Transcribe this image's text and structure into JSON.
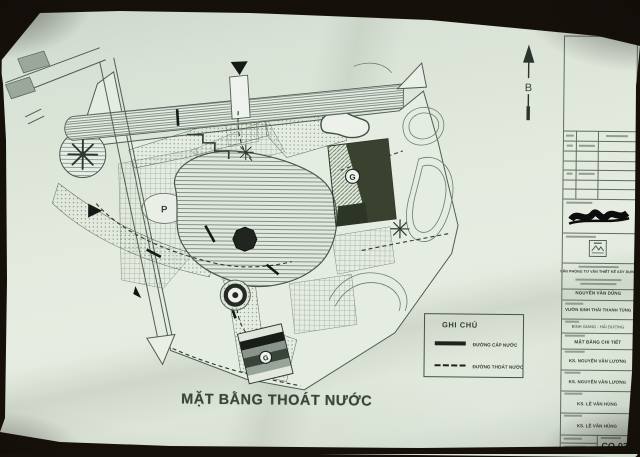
{
  "plan": {
    "title": "MẶT BẰNG THOÁT NƯỚC",
    "north_label": "B",
    "parking_label": "P",
    "building_marker": "G",
    "gate_marker": "G"
  },
  "legend": {
    "title": "GHI CHÚ",
    "items": [
      {
        "label": "ĐƯỜNG CẤP NƯỚC",
        "line_style": "solid"
      },
      {
        "label": "ĐƯỜNG THOÁT NƯỚC",
        "line_style": "dashed"
      }
    ]
  },
  "title_block": {
    "company": "VĂN PHÒNG TƯ VẤN THIẾT KẾ XÂY DỰNG",
    "architect": "NGUYỄN VĂN DŨNG",
    "project": "VƯỜN SINH THÁI THANH TÙNG",
    "location": "BÌNH GIANG - HẢI DƯƠNG",
    "drawing_title": "MẶT BẰNG CHI TIẾT",
    "designed_by": "KS. NGUYỄN VĂN LƯƠNG",
    "drawn_by": "KS. NGUYỄN VĂN LƯƠNG",
    "checked_by": "KS. LÊ VĂN HÙNG",
    "approved_by": "KS. LÊ VĂN HÙNG",
    "drawing_no": "CQ-03"
  },
  "colors": {
    "paper": "#e2e9dd",
    "ink": "#45534a",
    "road_gray": "#9aa79a",
    "building_dark": "#39422f",
    "water_hatch": "#5d6d5f"
  }
}
